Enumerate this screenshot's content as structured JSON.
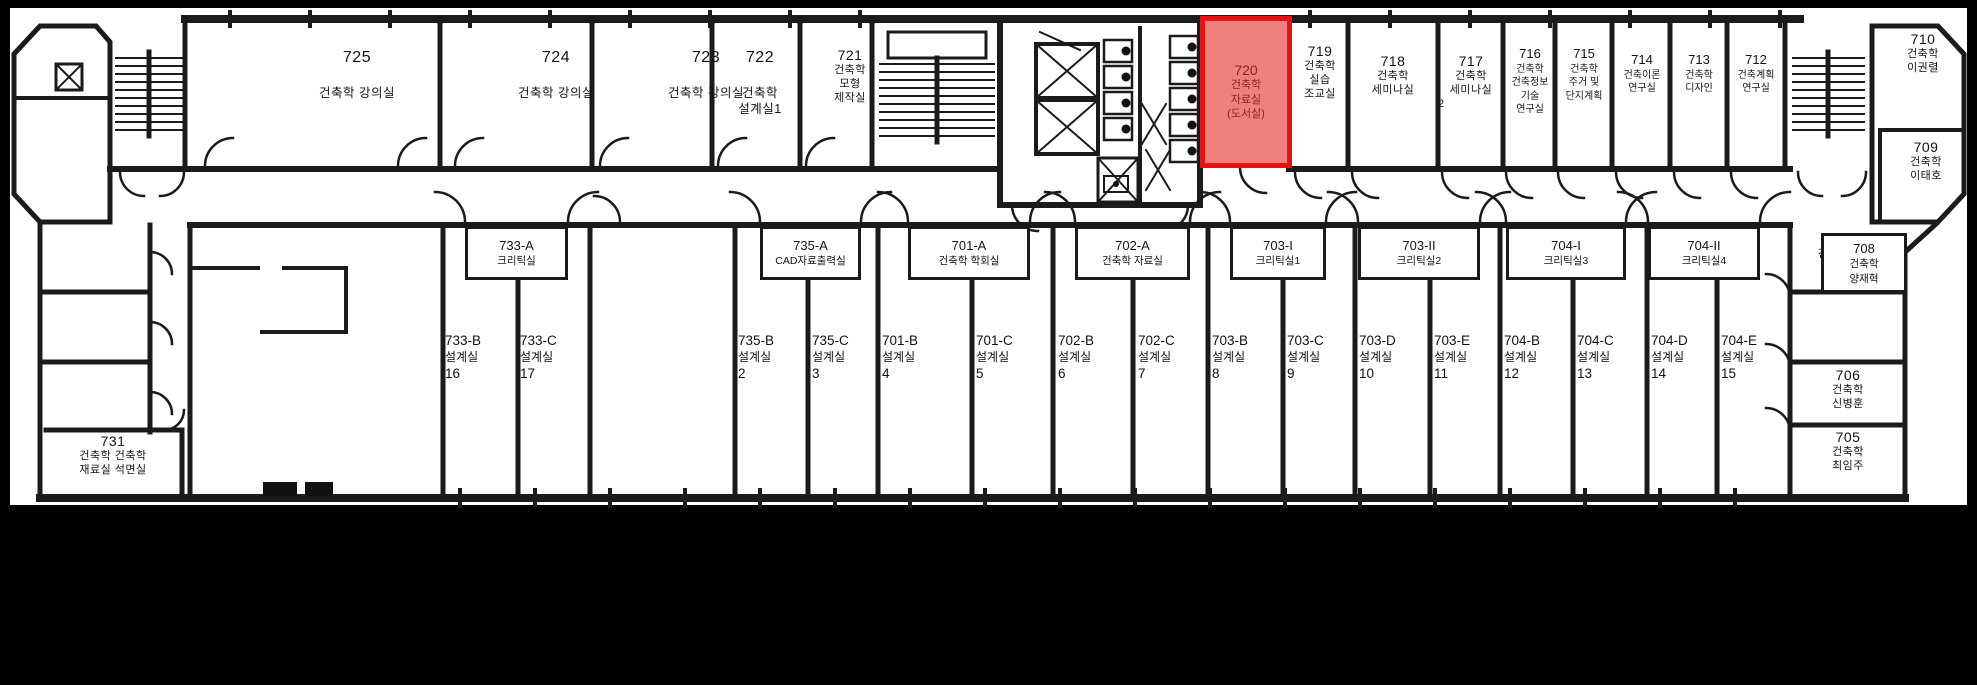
{
  "canvas": {
    "width": 1977,
    "height": 685,
    "background": "#000000",
    "plan_background": "#ffffff",
    "wall_color": "#1b1b1b"
  },
  "highlight": {
    "room": "720",
    "fill": "#f08080",
    "border": "#e51212",
    "text_color": "#8b2121"
  },
  "rooms": {
    "r725": {
      "number": "725",
      "name": "건축학 강의실"
    },
    "r724": {
      "number": "724",
      "name": "건축학 강의실"
    },
    "r723": {
      "number": "723",
      "name": "건축학 강의실"
    },
    "r722": {
      "number": "722",
      "l1": "건축학",
      "l2": "설계실1"
    },
    "r721": {
      "number": "721",
      "l1": "건축학",
      "l2": "모형",
      "l3": "제작실"
    },
    "r720": {
      "number": "720",
      "l1": "건축학",
      "l2": "자료실",
      "l3": "(도서실)",
      "highlighted": true
    },
    "r719": {
      "number": "719",
      "l1": "건축학",
      "l2": "실습",
      "l3": "조교실"
    },
    "r718": {
      "number": "718",
      "l1": "건축학",
      "l2": "세미나실"
    },
    "r717": {
      "number": "717",
      "l1": "건축학",
      "l2": "세미나실",
      "l3": "2"
    },
    "r716": {
      "number": "716",
      "l1": "건축학",
      "l2": "건축정보",
      "l3": "기술",
      "l4": "연구실"
    },
    "r715": {
      "number": "715",
      "l1": "건축학",
      "l2": "주거 및",
      "l3": "단지계획",
      "line4_redacted": true
    },
    "r714": {
      "number": "714",
      "l2": "건축이론",
      "l4": "연구실",
      "line1_redacted": true,
      "line3_redacted": true
    },
    "r713": {
      "number": "713",
      "l1": "건축학",
      "l3": "디자인",
      "line2_redacted": true,
      "line4_redacted": true
    },
    "r712": {
      "number": "712",
      "l1": "건축계획",
      "l3": "연구실",
      "line2_redacted": true
    },
    "r711": {
      "number": "711",
      "name": "건축학 암실"
    },
    "r710": {
      "number": "710",
      "l1": "건축학",
      "l2": "이권렬"
    },
    "r709": {
      "number": "709",
      "l1": "건축학",
      "l2": "이태호"
    },
    "r708": {
      "number": "708",
      "l1": "건축학",
      "l2": "양재혁"
    },
    "r706": {
      "number": "706",
      "l1": "건축학",
      "l2": "신병훈"
    },
    "r705": {
      "number": "705",
      "l1": "건축학",
      "l2": "최임주"
    },
    "r731": {
      "number": "731",
      "l1": "건축학 건축학",
      "l2": "재료실 석면실"
    },
    "r733A": {
      "number": "733-A",
      "name": "크리틱실"
    },
    "r735A": {
      "number": "735-A",
      "name": "CAD자료출력실"
    },
    "r701A": {
      "number": "701-A",
      "name": "건축학 학회실"
    },
    "r702A": {
      "number": "702-A",
      "name": "건축학 자료실"
    },
    "r703I": {
      "number": "703-I",
      "name": "크리틱실1"
    },
    "r703II": {
      "number": "703-II",
      "name": "크리틱실2"
    },
    "r704I": {
      "number": "704-I",
      "name": "크리틱실3"
    },
    "r704II": {
      "number": "704-II",
      "name": "크리틱실4"
    },
    "studios": [
      {
        "number": "733-B",
        "name": "설계실",
        "no": "16"
      },
      {
        "number": "733-C",
        "name": "설계실",
        "no": "17"
      },
      {
        "number": "735-B",
        "name": "설계실",
        "no": "2"
      },
      {
        "number": "735-C",
        "name": "설계실",
        "no": "3"
      },
      {
        "number": "701-B",
        "name": "설계실",
        "no": "4"
      },
      {
        "number": "701-C",
        "name": "설계실",
        "no": "5"
      },
      {
        "number": "702-B",
        "name": "설계실",
        "no": "6"
      },
      {
        "number": "702-C",
        "name": "설계실",
        "no": "7"
      },
      {
        "number": "703-B",
        "name": "설계실",
        "no": "8"
      },
      {
        "number": "703-C",
        "name": "설계실",
        "no": "9"
      },
      {
        "number": "703-D",
        "name": "설계실",
        "no": "10"
      },
      {
        "number": "703-E",
        "name": "설계실",
        "no": "11"
      },
      {
        "number": "704-B",
        "name": "설계실",
        "no": "12"
      },
      {
        "number": "704-C",
        "name": "설계실",
        "no": "13"
      },
      {
        "number": "704-D",
        "name": "설계실",
        "no": "14"
      },
      {
        "number": "704-E",
        "name": "설계실",
        "no": "15"
      }
    ]
  }
}
